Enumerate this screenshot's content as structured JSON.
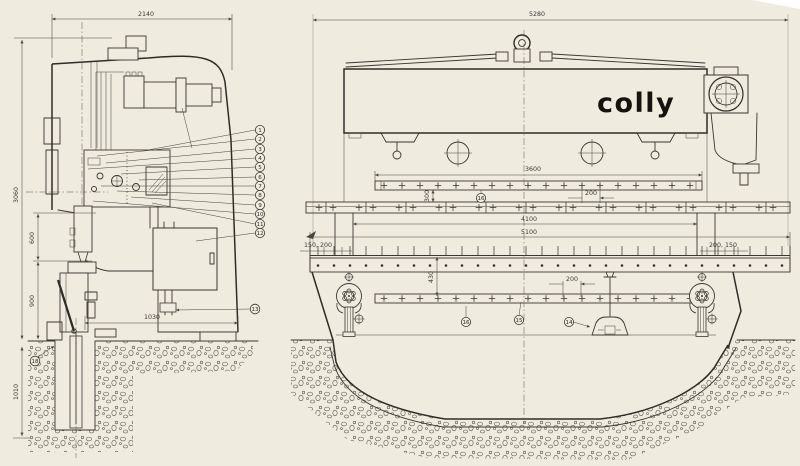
{
  "brand": {
    "logo": "colly"
  },
  "colors": {
    "paper": "#f0ebdf",
    "ink": "#3a3632",
    "dim": "#4a453d"
  },
  "side_view": {
    "dim_width_top": "2140",
    "dim_height_overall": "3060",
    "dim_upper": "600",
    "dim_lower": "900",
    "dim_1030": "1030",
    "dim_pit_depth": "1010",
    "balloons": [
      "1",
      "2",
      "3",
      "4",
      "5",
      "6",
      "7",
      "8",
      "9",
      "10",
      "11",
      "12"
    ],
    "balloon_13": "13",
    "balloon_18": "18"
  },
  "front_view": {
    "dim_width_top": "5280",
    "dim_punch_strip": "3600",
    "dim_strip_gap": "300",
    "dim_inner_width": "4100",
    "dim_bed_width": "5100",
    "dim_left_offsets": "150, 200",
    "dim_right_offsets": "200, 150",
    "dim_bolt_pitch_upper": "200",
    "dim_bolt_pitch_lower": "200",
    "dim_bed_face": "430",
    "balloon_14": "14",
    "balloon_15": "15",
    "balloon_16_upper": "16",
    "balloon_16_lower": "16"
  }
}
